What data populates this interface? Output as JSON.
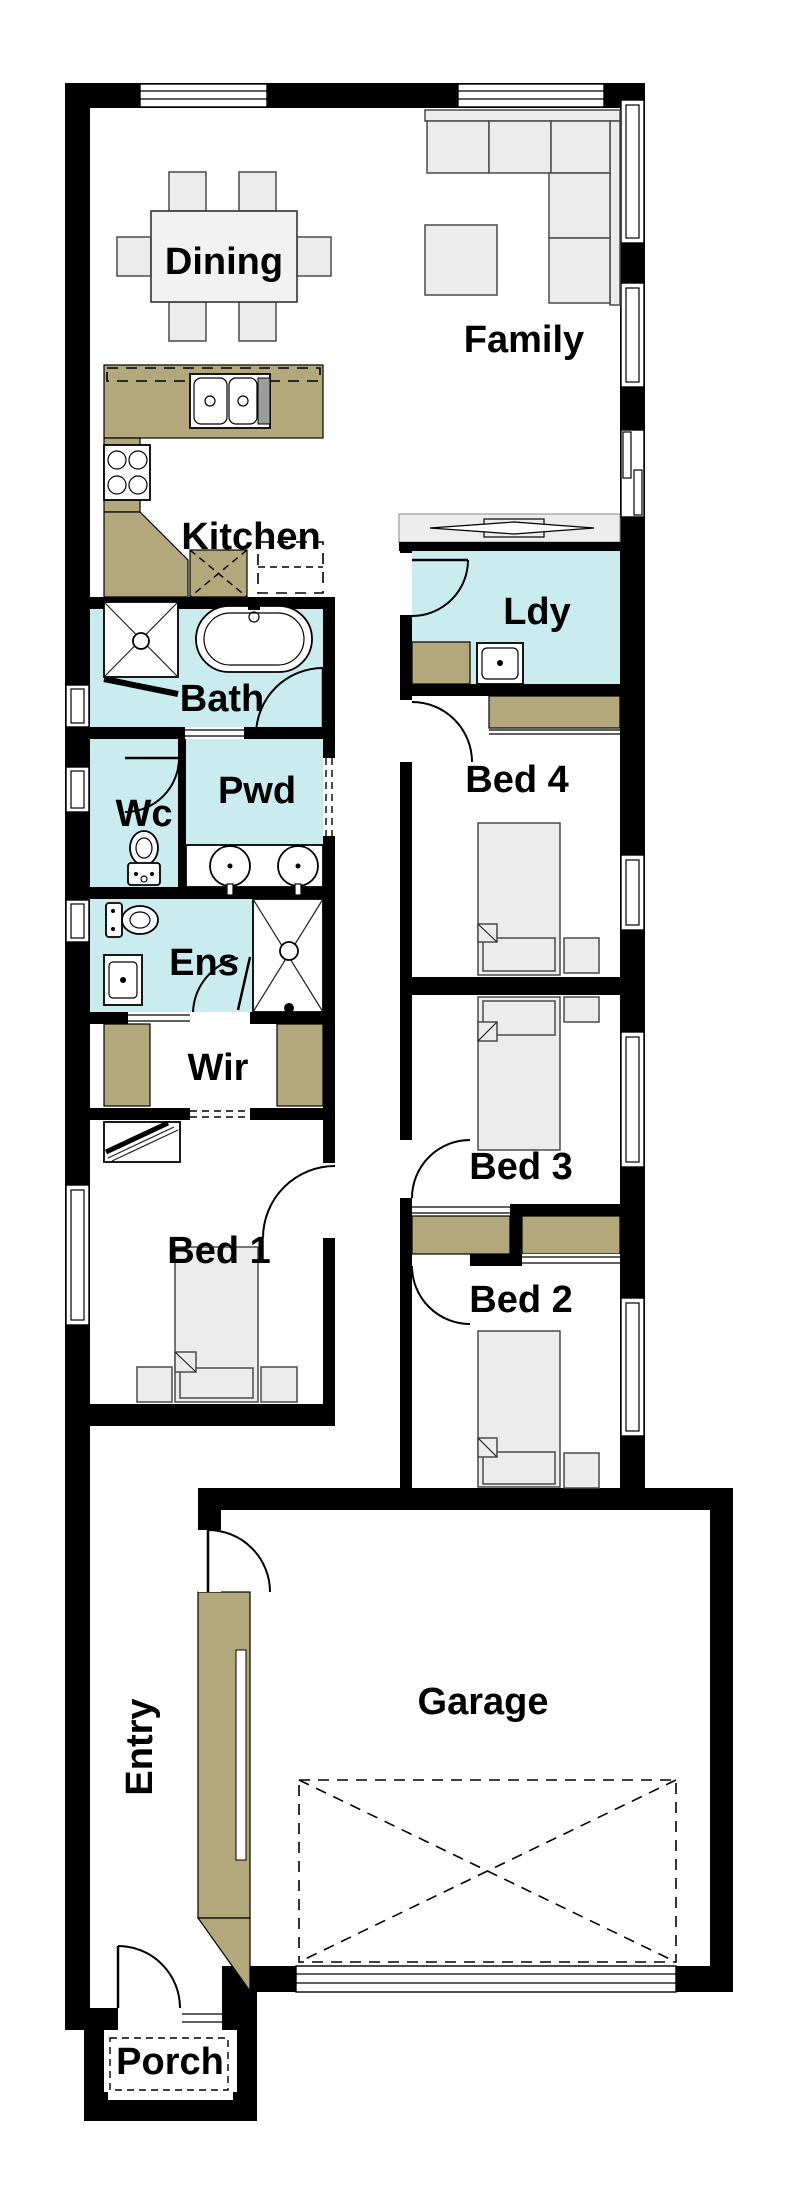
{
  "title": "Single storey narrow-lot house floor plan",
  "colors": {
    "wall": "#000000",
    "floor": "#ffffff",
    "wet": "#cbecee",
    "cab": "#b2a87b",
    "furn": "#ececec",
    "band": "#ededed"
  },
  "rooms": {
    "dining": {
      "label": "Dining"
    },
    "family": {
      "label": "Family"
    },
    "kitchen": {
      "label": "Kitchen"
    },
    "ldy": {
      "label": "Ldy"
    },
    "bath": {
      "label": "Bath"
    },
    "wc": {
      "label": "Wc"
    },
    "pwd": {
      "label": "Pwd"
    },
    "bed4": {
      "label": "Bed 4"
    },
    "ens": {
      "label": "Ens"
    },
    "wir": {
      "label": "Wir"
    },
    "bed3": {
      "label": "Bed 3"
    },
    "bed1": {
      "label": "Bed 1"
    },
    "bed2": {
      "label": "Bed 2"
    },
    "garage": {
      "label": "Garage"
    },
    "entry": {
      "label": "Entry"
    },
    "porch": {
      "label": "Porch"
    }
  }
}
